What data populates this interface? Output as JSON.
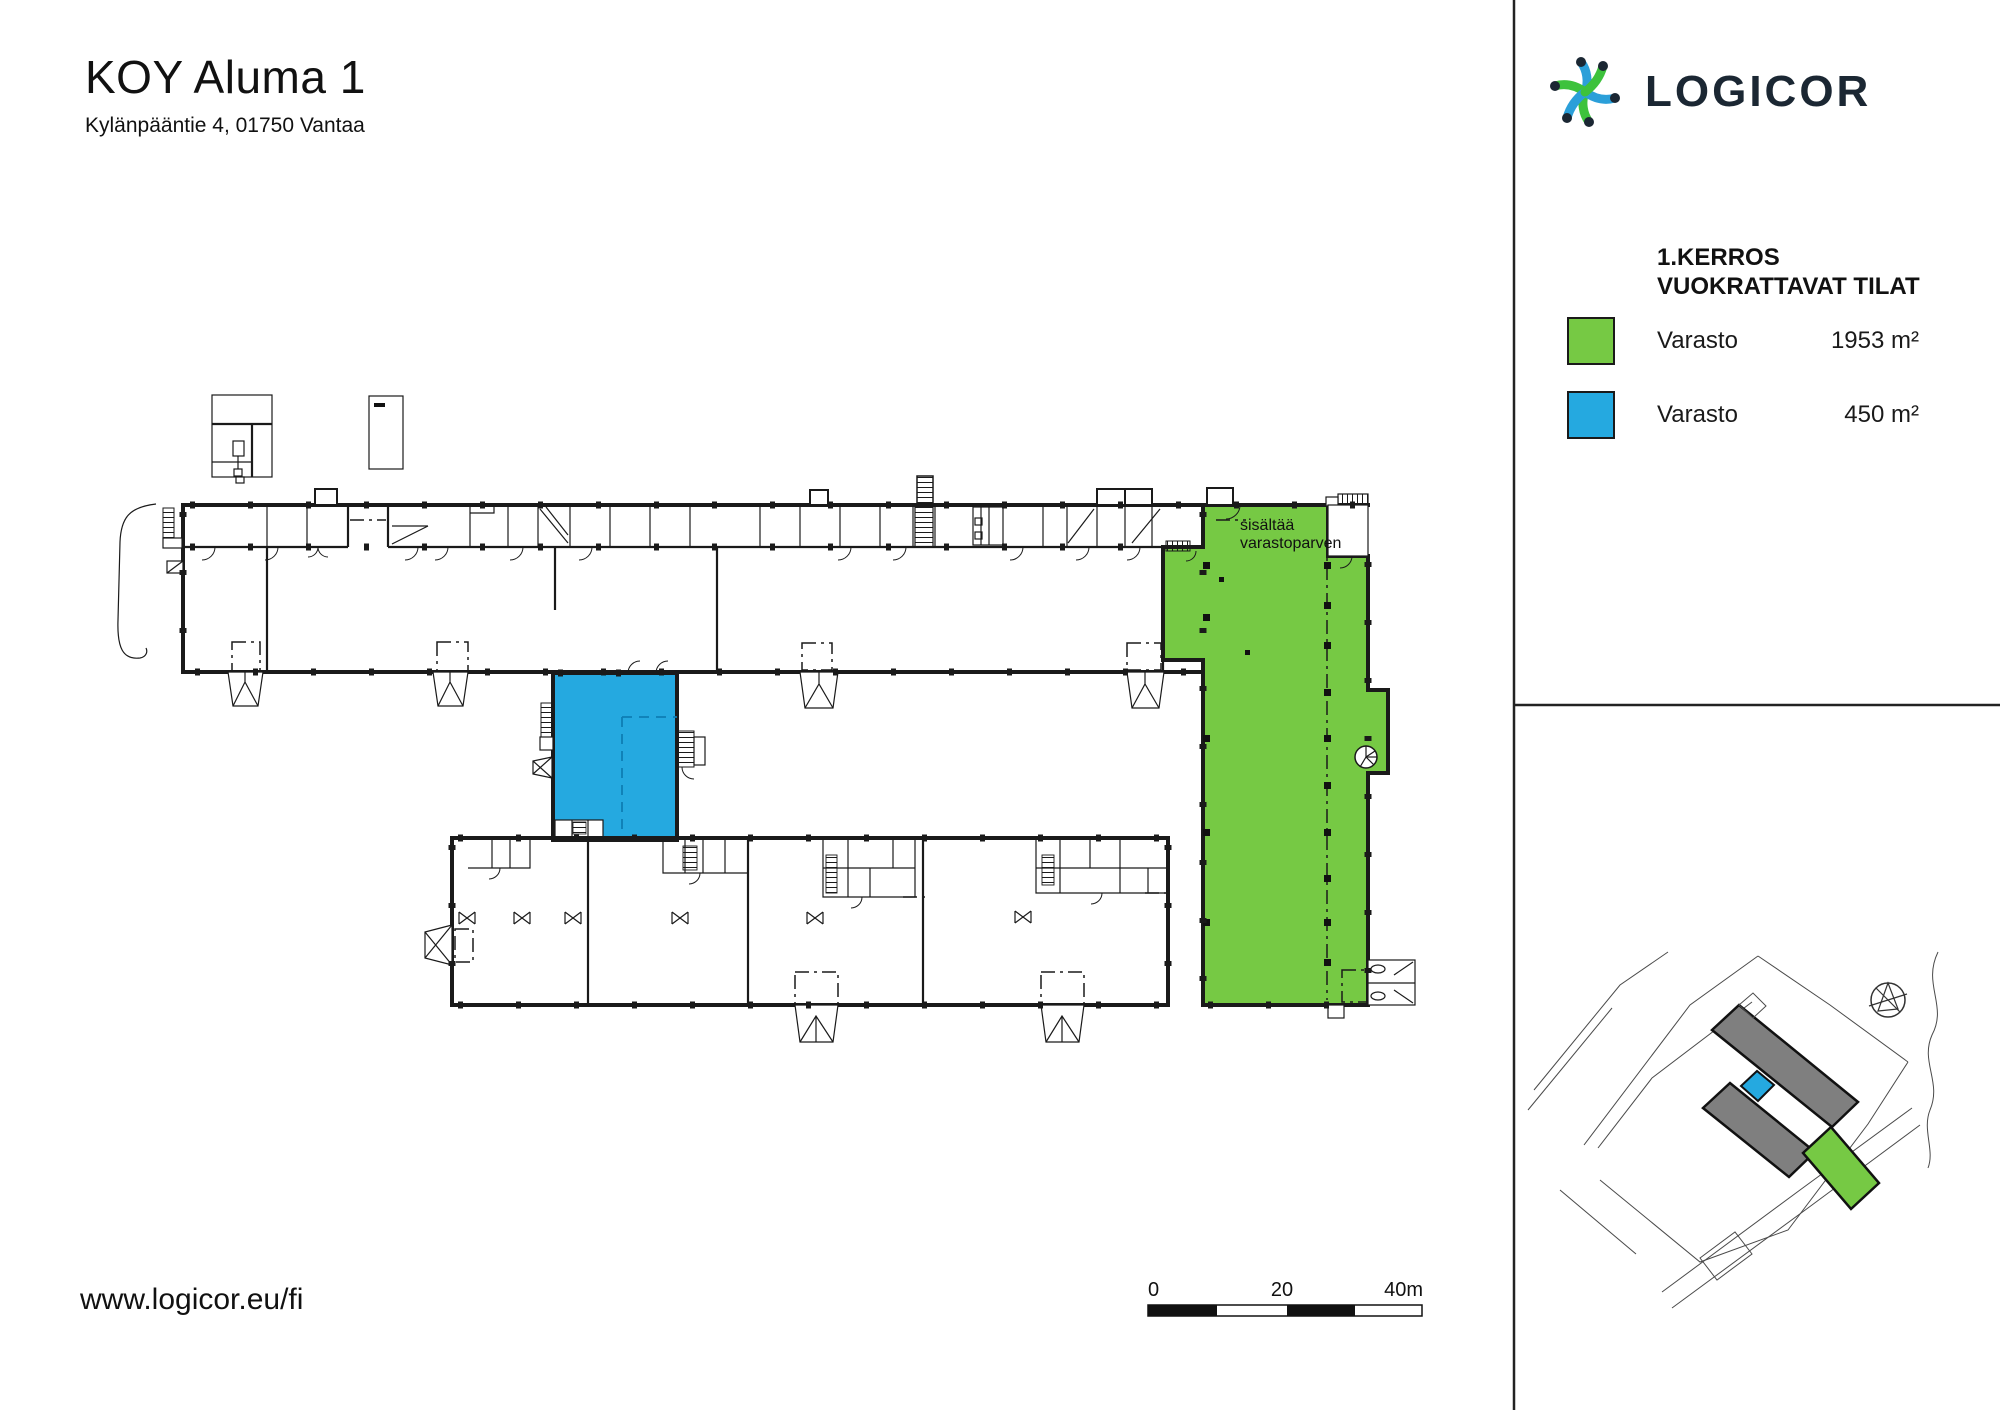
{
  "document": {
    "title": "KOY Aluma 1",
    "address": "Kylänpääntie 4, 01750 Vantaa",
    "website": "www.logicor.eu/fi"
  },
  "brand": {
    "wordmark": "LOGICOR"
  },
  "legend": {
    "title_line1": "1.KERROS",
    "title_line2": "VUOKRATTAVAT TILAT",
    "items": [
      {
        "label": "Varasto",
        "area": "1953 m²",
        "color": "#76C944"
      },
      {
        "label": "Varasto",
        "area": "450 m²",
        "color": "#25A9E0"
      }
    ]
  },
  "plan": {
    "annotation_line1": "sisältää",
    "annotation_line2": "varastoparven"
  },
  "scale_bar": {
    "zero": "0",
    "mid": "20",
    "end": "40m"
  },
  "colors": {
    "highlight_green": "#76C944",
    "highlight_blue": "#25A9E0",
    "line": "#1a1a1a",
    "brand_navy": "#1B2733",
    "brand_blue": "#2B9FD9",
    "brand_green": "#3DC23C",
    "site_gray": "#7f7f7f"
  }
}
